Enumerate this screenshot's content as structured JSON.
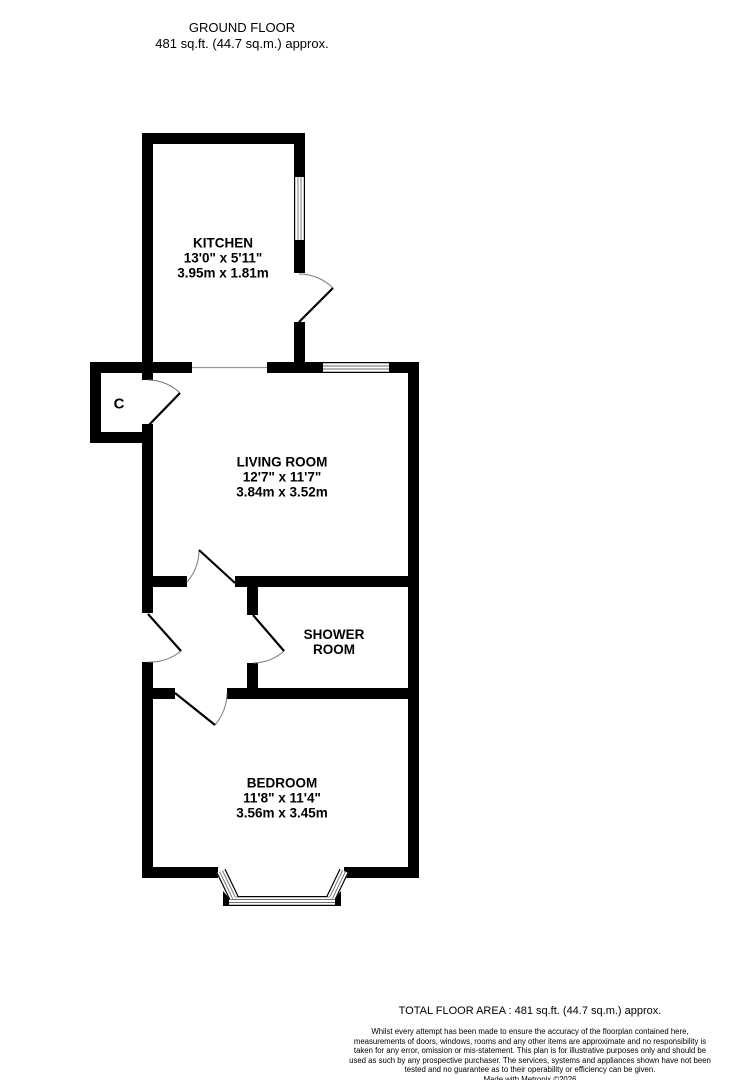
{
  "title": {
    "line1": "GROUND FLOOR",
    "line2": "481 sq.ft. (44.7 sq.m.) approx."
  },
  "rooms": [
    {
      "id": "kitchen",
      "lines": [
        "KITCHEN",
        "13'0\" x 5'11\"",
        "3.95m x 1.81m"
      ],
      "cx": 223,
      "cy": 258
    },
    {
      "id": "living-room",
      "lines": [
        "LIVING ROOM",
        "12'7\" x 11'7\"",
        "3.84m x 3.52m"
      ],
      "cx": 282,
      "cy": 477
    },
    {
      "id": "shower-room",
      "lines": [
        "SHOWER",
        "ROOM"
      ],
      "cx": 334,
      "cy": 642
    },
    {
      "id": "bedroom",
      "lines": [
        "BEDROOM",
        "11'8\" x 11'4\"",
        "3.56m x 3.45m"
      ],
      "cx": 282,
      "cy": 798
    },
    {
      "id": "cupboard",
      "lines": [
        "C"
      ],
      "cx": 119,
      "cy": 404,
      "small": true
    }
  ],
  "footer": {
    "total": "TOTAL FLOOR AREA : 481 sq.ft. (44.7 sq.m.) approx.",
    "disclaimer": "Whilst every attempt has been made to ensure the accuracy of the floorplan contained here, measurements of doors, windows, rooms and any other items are approximate and no responsibility is taken for any error, omission or mis-statement. This plan is for illustrative purposes only and should be used as such by any prospective purchaser. The services, systems and appliances shown have not been tested and no guarantee as to their operability or efficiency can be given.",
    "credit": "Made with Metropix ©2026"
  },
  "colors": {
    "background": "#ffffff",
    "wall": "#000000",
    "window_line": "#6e6e6e",
    "arc": "#7a7a7a",
    "opening": "#999999",
    "text": "#000000"
  },
  "plan": {
    "width": 741,
    "height": 1080,
    "walls": [
      [
        142,
        133,
        163,
        11
      ],
      [
        142,
        133,
        11,
        240
      ],
      [
        294,
        133,
        11,
        44
      ],
      [
        294,
        240,
        11,
        33
      ],
      [
        294,
        322,
        11,
        51
      ],
      [
        153,
        362,
        39,
        11
      ],
      [
        267,
        362,
        27,
        11
      ],
      [
        305,
        362,
        18,
        11
      ],
      [
        389,
        362,
        30,
        11
      ],
      [
        408,
        362,
        11,
        516
      ],
      [
        90,
        362,
        63,
        11
      ],
      [
        90,
        362,
        11,
        81
      ],
      [
        90,
        432,
        63,
        11
      ],
      [
        142,
        373,
        11,
        7
      ],
      [
        142,
        424,
        11,
        8
      ],
      [
        142,
        443,
        11,
        170
      ],
      [
        142,
        662,
        11,
        216
      ],
      [
        142,
        576,
        45,
        11
      ],
      [
        235,
        576,
        184,
        11
      ],
      [
        247,
        587,
        11,
        28
      ],
      [
        247,
        663,
        11,
        25
      ],
      [
        142,
        688,
        33,
        11
      ],
      [
        227,
        688,
        192,
        11
      ],
      [
        142,
        867,
        76,
        11
      ],
      [
        344,
        867,
        75,
        11
      ]
    ],
    "polygons": [
      [
        [
          223,
          891
        ],
        [
          236,
          906
        ],
        [
          223,
          906
        ]
      ],
      [
        [
          341,
          891
        ],
        [
          341,
          906
        ],
        [
          328,
          906
        ]
      ]
    ],
    "openings": [
      [
        192,
        367.5,
        267,
        367.5
      ]
    ],
    "windows": [
      [
        299.5,
        177,
        299.5,
        240,
        11
      ],
      [
        323,
        367.5,
        389,
        367.5,
        11
      ],
      [
        229,
        901,
        335,
        901,
        10
      ],
      [
        221,
        871,
        234,
        898,
        10
      ],
      [
        331,
        898,
        344,
        871,
        10
      ]
    ],
    "doors": [
      {
        "id": "kitchen-door",
        "hinge": [
          299,
          322
        ],
        "closed": [
          299,
          274
        ],
        "tip": [
          333,
          288
        ],
        "sweep": 1
      },
      {
        "id": "cupboard-door",
        "hinge": [
          148,
          426
        ],
        "closed": [
          148,
          380
        ],
        "tip": [
          180,
          393
        ],
        "sweep": 1
      },
      {
        "id": "living-room-door",
        "hinge": [
          235,
          583
        ],
        "closed": [
          187,
          582
        ],
        "tip": [
          199,
          550
        ],
        "sweep": 0
      },
      {
        "id": "entrance-door",
        "hinge": [
          148,
          614
        ],
        "closed": [
          148,
          662
        ],
        "tip": [
          181,
          651
        ],
        "sweep": 0
      },
      {
        "id": "shower-room-door",
        "hinge": [
          253,
          615
        ],
        "closed": [
          253,
          663
        ],
        "tip": [
          284,
          651
        ],
        "sweep": 0
      },
      {
        "id": "bedroom-door",
        "hinge": [
          175,
          693
        ],
        "closed": [
          227,
          693
        ],
        "tip": [
          215,
          725
        ],
        "sweep": 1
      }
    ]
  }
}
